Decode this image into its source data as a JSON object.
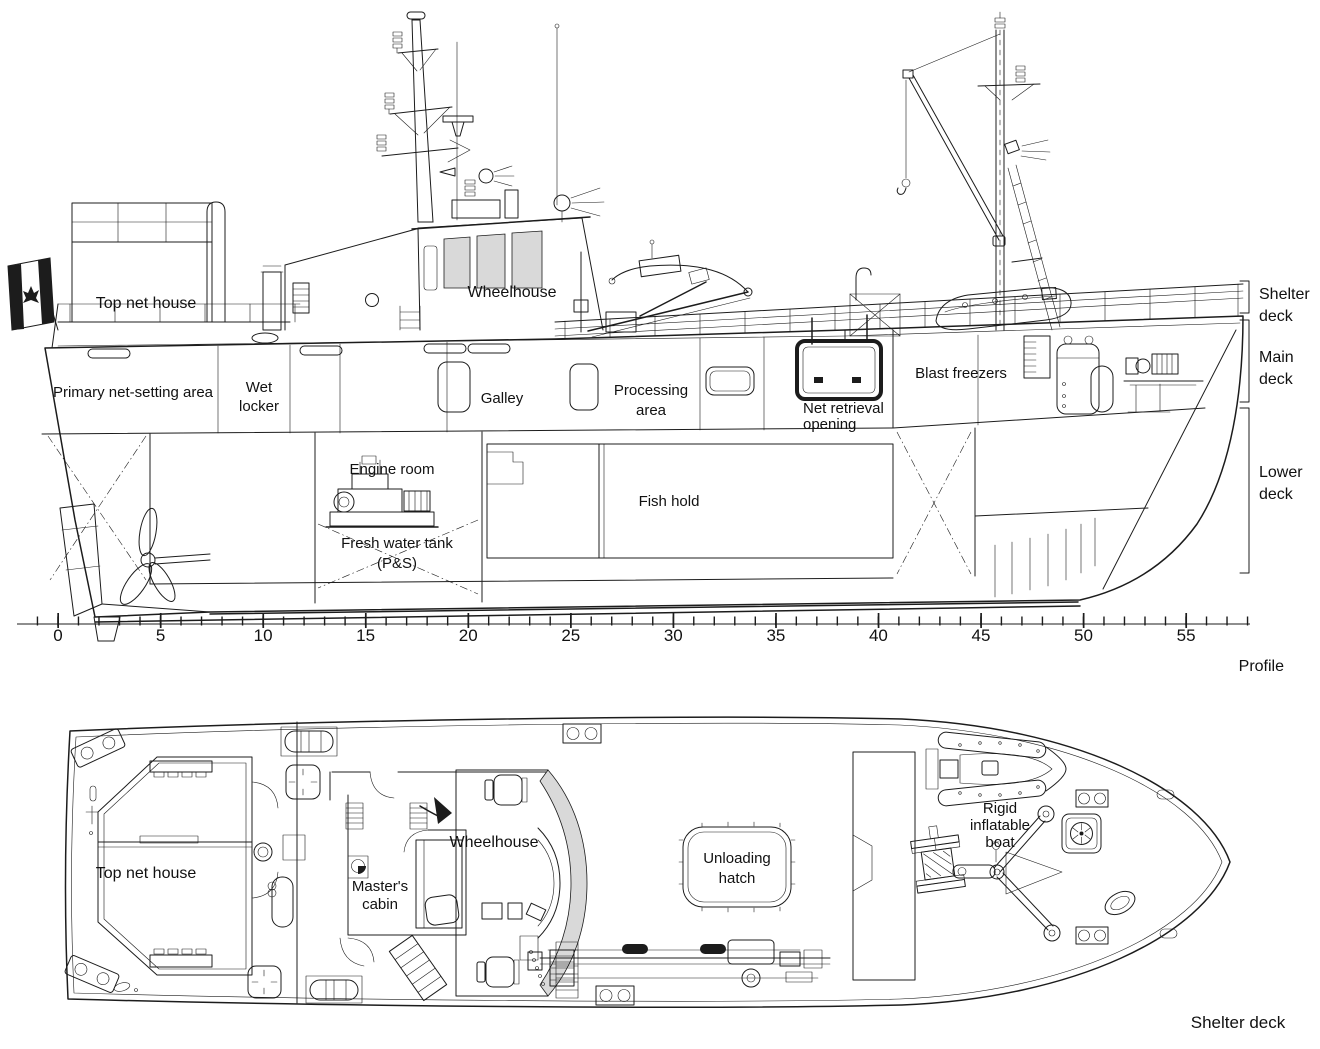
{
  "profile": {
    "caption": "Profile",
    "areas": {
      "top_net_house": "Top net house",
      "wheelhouse": "Wheelhouse",
      "primary_net_setting_area": "Primary net-setting area",
      "wet_locker": [
        "Wet",
        "locker"
      ],
      "galley": "Galley",
      "processing_area": [
        "Processing",
        "area"
      ],
      "net_retrieval_opening": [
        "Net retrieval",
        "opening"
      ],
      "blast_freezers": "Blast freezers",
      "engine_room": "Engine room",
      "fish_hold": "Fish hold",
      "fresh_water_tank": [
        "Fresh water tank",
        "(P&S)"
      ]
    },
    "deck_levels": {
      "shelter": [
        "Shelter",
        "deck"
      ],
      "main": [
        "Main",
        "deck"
      ],
      "lower": [
        "Lower",
        "deck"
      ]
    },
    "scale_ticks": [
      "0",
      "5",
      "10",
      "15",
      "20",
      "25",
      "30",
      "35",
      "40",
      "45",
      "50",
      "55"
    ]
  },
  "plan": {
    "caption": "Shelter deck",
    "areas": {
      "top_net_house": "Top net house",
      "masters_cabin": [
        "Master's",
        "cabin"
      ],
      "wheelhouse": "Wheelhouse",
      "unloading_hatch": [
        "Unloading",
        "hatch"
      ],
      "rigid_inflatable_boat": [
        "Rigid",
        "inflatable",
        "boat"
      ]
    }
  },
  "colors": {
    "line": "#1c1c1c",
    "background": "#ffffff"
  }
}
